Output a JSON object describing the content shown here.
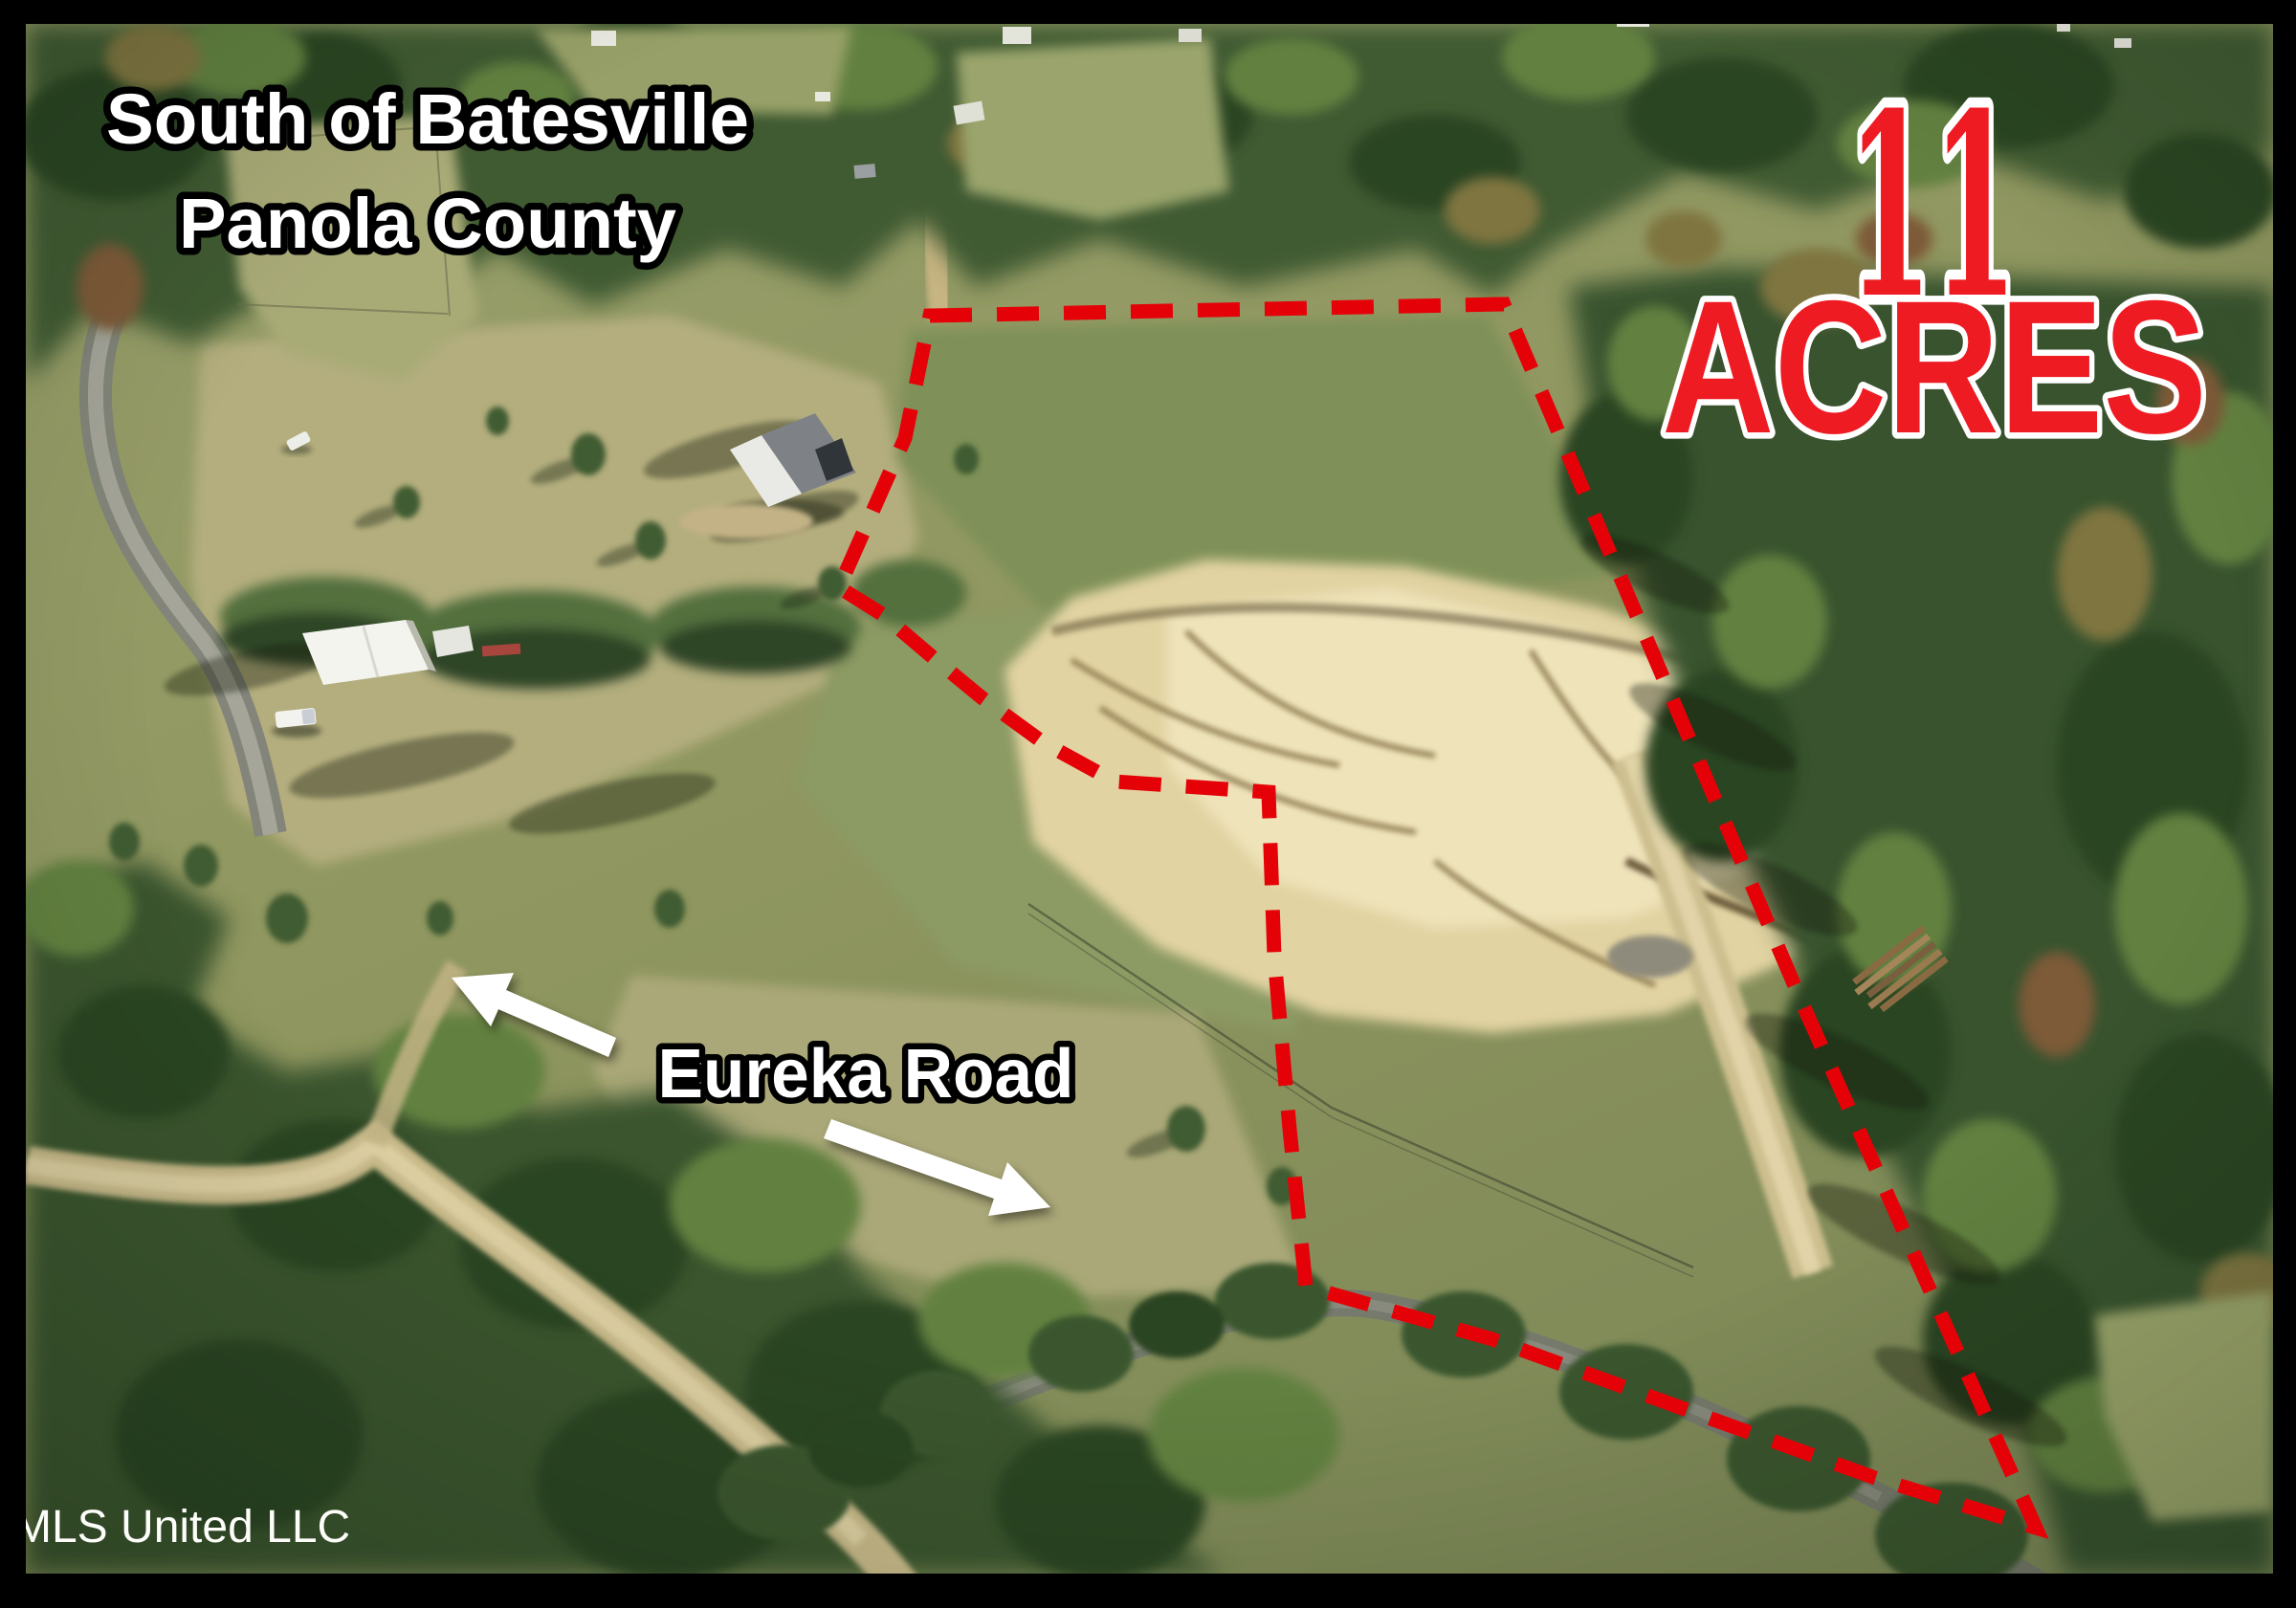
{
  "overlays": {
    "location": {
      "line1": "South of Batesville",
      "line2": "Panola County"
    },
    "acreage": {
      "number": "11",
      "unit": "ACRES"
    },
    "road_label": "Eureka Road",
    "watermark": "MLS United LLC"
  },
  "colors": {
    "boundary_red": "#e40208",
    "acreage_red": "#ee1b23",
    "text_white": "#ffffff",
    "text_outline_black": "#000000",
    "acreage_outline_white": "#ffffff",
    "watermark_white": "#fdfdfa",
    "frame_black": "#000000"
  }
}
